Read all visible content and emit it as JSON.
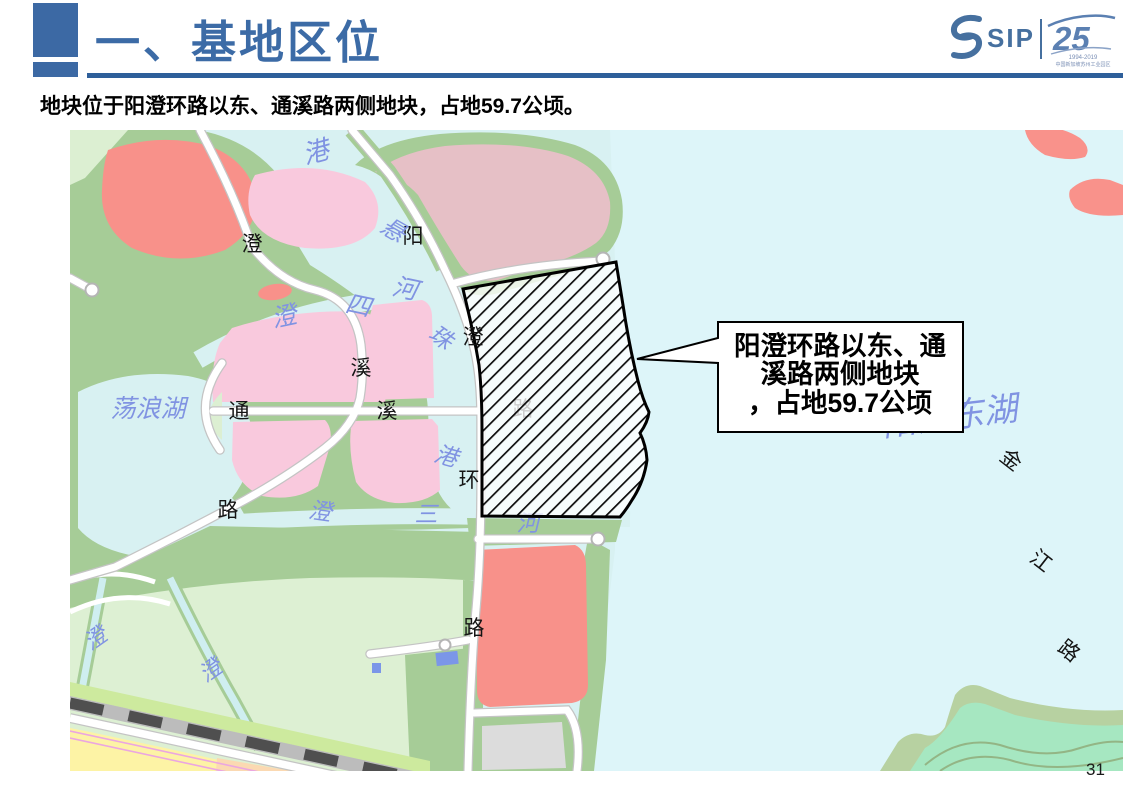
{
  "slide": {
    "title": "一、基地区位",
    "subtitle": "地块位于阳澄环路以东、通溪路两侧地块，占地59.7公顷。",
    "page_number": "31"
  },
  "logo": {
    "sip_wordmark": "SIP",
    "anniversary_number": "25",
    "anniversary_years": "1994-2019",
    "anniversary_caption": "中国新加坡苏州工业园区"
  },
  "map": {
    "callout": {
      "line1": "阳澄环路以东、通",
      "line2": "溪路两侧地块",
      "line3": "，占地59.7公顷"
    },
    "road_labels": [
      "澄",
      "阳",
      "澄",
      "溪",
      "通",
      "溪",
      "环",
      "路",
      "路",
      "金",
      "江",
      "路",
      "路"
    ],
    "water_labels": [
      "港",
      "悬",
      "澄",
      "四",
      "河",
      "珠",
      "港",
      "澄",
      "三",
      "河",
      "荡浪湖",
      "阳澄东湖",
      "澄",
      "澄"
    ]
  },
  "colors": {
    "accent_blue": "#3c69a4",
    "underline_blue": "#2e5f9a",
    "logo_blue": "#46709f",
    "water": "#d8f1f2",
    "east_lake": "#ddf5f9",
    "park_green": "#a6cc97",
    "pale_green": "#ddf0d3",
    "parcel_pink": "#f9c9dd",
    "parcel_rose": "#e6c0c6",
    "parcel_salmon": "#f8918a",
    "parcel_gray": "#dcdcdc",
    "parcel_yellow": "#fdf3a5",
    "parcel_peach": "#fbd9b2",
    "railway_gray": "#bcbcbc",
    "railway_dash": "#4f4f4f",
    "metro_magenta": "#eba6e0",
    "mint_green": "#a6e7c1",
    "water_label_blue": "#8093e2",
    "lake_label_lavender": "#9aa0e8",
    "site_hatch": "#0b0b0b"
  }
}
